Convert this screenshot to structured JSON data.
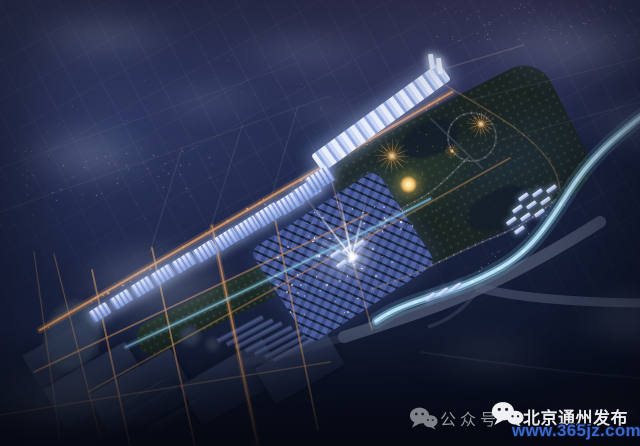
{
  "watermark": {
    "label": "公众号",
    "account": "北京通州发布",
    "site": "www.365jz.com"
  },
  "icons": {
    "label_icon": "wechat-icon",
    "account_icon": "wechat-icon"
  },
  "colors": {
    "watermark_label": "#94979d",
    "watermark_account": "#e9ebef",
    "watermark_site": "#3b68cc",
    "sky_top": "#3a3f63",
    "sky_bottom": "#090d1c",
    "street_light_orange": "#e09a5f",
    "river_glow": "#8fd0ea",
    "lit_buildings": "#dfe7fa",
    "fireworks": "#ffb977",
    "highway_grey": "#535e76"
  }
}
